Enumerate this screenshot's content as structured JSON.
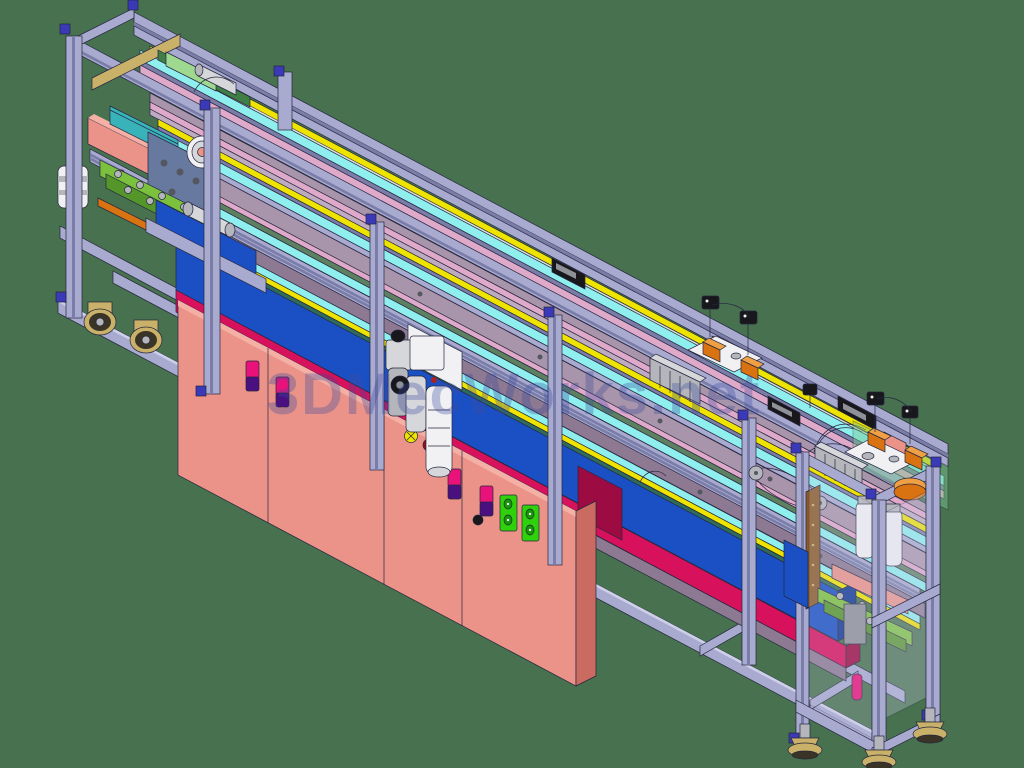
{
  "watermark": {
    "text": "3DMecWorks.net",
    "color": "#3a4a9e"
  },
  "background": {
    "color": "#47714f"
  },
  "colors": {
    "lav": "#a8aad0",
    "lavLight": "#cdd0e8",
    "lavDark": "#7a7da8",
    "lavShadow": "#585c84",
    "edge": "#26263e",
    "mauve": "#a995ab",
    "mauveLight": "#bfabc1",
    "mauveDark": "#8d7992",
    "pink": "#dfa9c9",
    "cyan": "#8fefef",
    "yellow": "#efe400",
    "yellowDark": "#9a9300",
    "sageGreen": "#5d8060",
    "tealLip": "#2e6b5c",
    "blue": "#1b50c5",
    "blueDark": "#123a94",
    "crimson": "#d8115c",
    "crimsonDark": "#9c0c42",
    "salmon": "#eb9389",
    "salmonLight": "#f5b0a6",
    "salmonDark": "#c9695e",
    "salmonSide": "#c96b60",
    "magenta": "#e8127a",
    "handlePurple": "#4a1080",
    "socketGreen": "#2fd00c",
    "socketGreenDark": "#149903",
    "lime": "#7cc13e",
    "limeDark": "#55962a",
    "orange": "#d97210",
    "orangeDark": "#8a4a08",
    "orangeLight": "#efa044",
    "tan": "#c9b169",
    "tanDark": "#857140",
    "white": "#f1f1f4",
    "gray1": "#d6d7da",
    "gray2": "#b4b6bc",
    "gray3": "#8e9198",
    "grayDark": "#54575f",
    "black": "#17171c",
    "tealBelt": "#39b3ba",
    "slate": "#67799f",
    "glassGreen": "#7ec98f",
    "connector": "#3a3ab8",
    "wheelDark": "#3a3426",
    "railGreen": "#3f7f46",
    "sliderGreen": "#9fd98f"
  },
  "scene": {
    "kind": "isometric-3d-cad-render",
    "parts": [
      "aluminum-extrusion-frame",
      "linear-rail-assembly",
      "energy-chain",
      "belt-conveyor",
      "electrical-cabinet-doors",
      "pneumatic-frl-unit",
      "left-press-station",
      "right-press-station",
      "gripper-carriages",
      "inductive-sensor-posts",
      "caster-wheels",
      "leveling-feet",
      "timing-belt-drive",
      "power-socket-panel",
      "push-buttons",
      "watermark-overlay"
    ]
  }
}
